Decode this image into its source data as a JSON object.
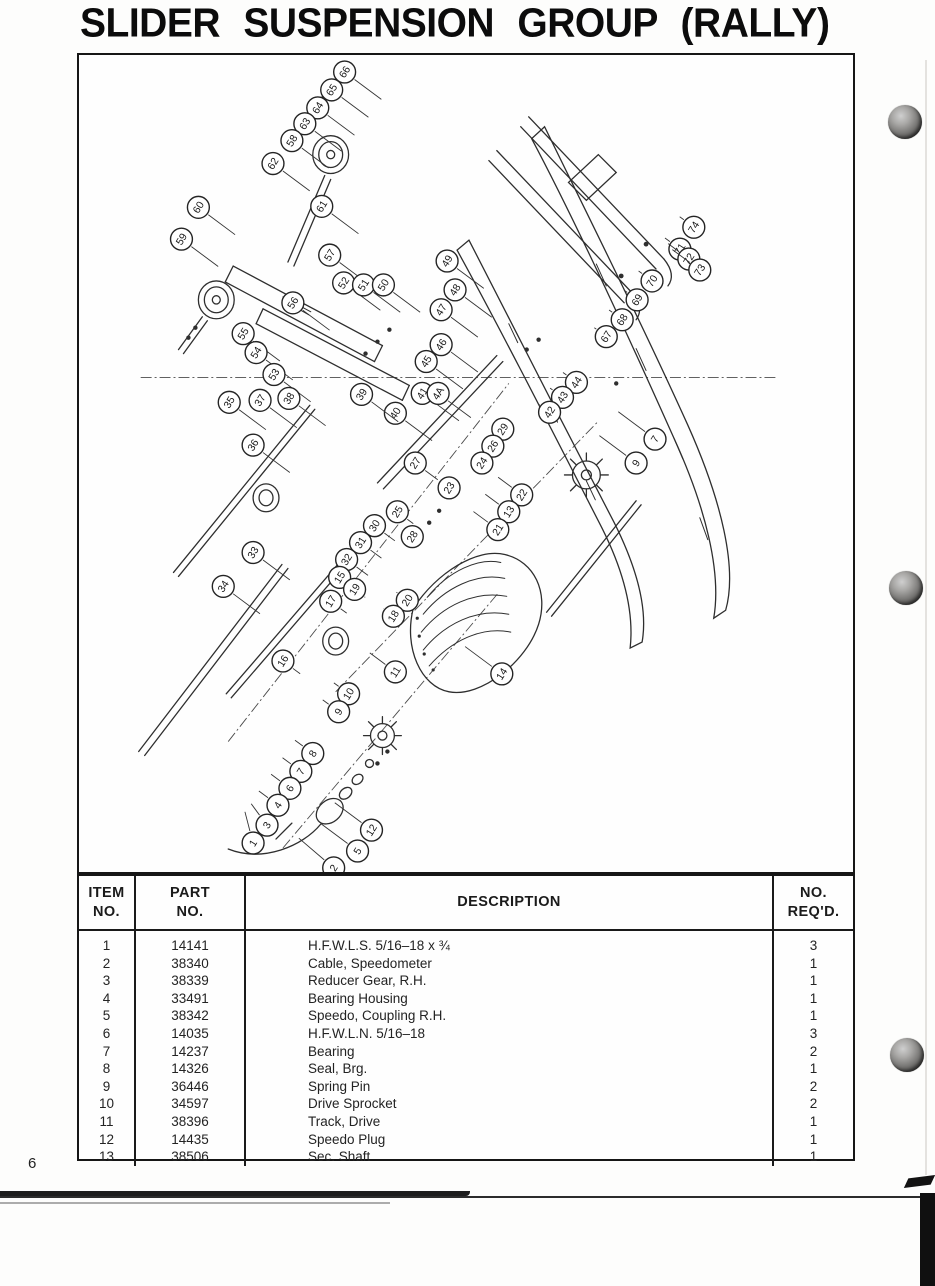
{
  "page": {
    "title": "SLIDER SUSPENSION GROUP (RALLY)",
    "page_number": "6"
  },
  "table": {
    "headers": {
      "item": [
        "ITEM",
        "NO."
      ],
      "part": [
        "PART",
        "NO."
      ],
      "description": "DESCRIPTION",
      "req": [
        "NO.",
        "REQ'D."
      ]
    },
    "rows": [
      {
        "item": "1",
        "part": "14141",
        "description": "H.F.W.L.S. 5/16–18 x ¾",
        "req": "3"
      },
      {
        "item": "2",
        "part": "38340",
        "description": "Cable, Speedometer",
        "req": "1"
      },
      {
        "item": "3",
        "part": "38339",
        "description": "Reducer Gear, R.H.",
        "req": "1"
      },
      {
        "item": "4",
        "part": "33491",
        "description": "Bearing Housing",
        "req": "1"
      },
      {
        "item": "5",
        "part": "38342",
        "description": "Speedo, Coupling R.H.",
        "req": "1"
      },
      {
        "item": "6",
        "part": "14035",
        "description": "H.F.W.L.N. 5/16–18",
        "req": "3"
      },
      {
        "item": "7",
        "part": "14237",
        "description": "Bearing",
        "req": "2"
      },
      {
        "item": "8",
        "part": "14326",
        "description": "Seal, Brg.",
        "req": "1"
      },
      {
        "item": "9",
        "part": "36446",
        "description": "Spring Pin",
        "req": "2"
      },
      {
        "item": "10",
        "part": "34597",
        "description": "Drive Sprocket",
        "req": "2"
      },
      {
        "item": "11",
        "part": "38396",
        "description": "Track, Drive",
        "req": "1"
      },
      {
        "item": "12",
        "part": "14435",
        "description": "Speedo Plug",
        "req": "1"
      },
      {
        "item": "13",
        "part": "38506",
        "description": "Sec. Shaft",
        "req": "1"
      }
    ]
  },
  "diagram": {
    "callouts": [
      {
        "n": "66",
        "x": 267,
        "y": 17
      },
      {
        "n": "65",
        "x": 254,
        "y": 35
      },
      {
        "n": "64",
        "x": 240,
        "y": 53
      },
      {
        "n": "63",
        "x": 227,
        "y": 69
      },
      {
        "n": "58",
        "x": 214,
        "y": 86
      },
      {
        "n": "62",
        "x": 195,
        "y": 109
      },
      {
        "n": "61",
        "x": 244,
        "y": 152
      },
      {
        "n": "60",
        "x": 120,
        "y": 153
      },
      {
        "n": "59",
        "x": 103,
        "y": 185
      },
      {
        "n": "57",
        "x": 252,
        "y": 201
      },
      {
        "n": "56",
        "x": 215,
        "y": 249
      },
      {
        "n": "55",
        "x": 165,
        "y": 280
      },
      {
        "n": "54",
        "x": 178,
        "y": 299
      },
      {
        "n": "53",
        "x": 196,
        "y": 321
      },
      {
        "n": "52",
        "x": 266,
        "y": 229
      },
      {
        "n": "51",
        "x": 286,
        "y": 231
      },
      {
        "n": "50",
        "x": 306,
        "y": 231
      },
      {
        "n": "49",
        "x": 370,
        "y": 207
      },
      {
        "n": "48",
        "x": 378,
        "y": 236
      },
      {
        "n": "47",
        "x": 364,
        "y": 256
      },
      {
        "n": "46",
        "x": 364,
        "y": 291
      },
      {
        "n": "45",
        "x": 349,
        "y": 308
      },
      {
        "n": "44",
        "x": 500,
        "y": 329
      },
      {
        "n": "43",
        "x": 486,
        "y": 344
      },
      {
        "n": "42",
        "x": 473,
        "y": 359
      },
      {
        "n": "41",
        "x": 345,
        "y": 340
      },
      {
        "n": "4A",
        "x": 361,
        "y": 340
      },
      {
        "n": "40",
        "x": 318,
        "y": 360
      },
      {
        "n": "39",
        "x": 284,
        "y": 341
      },
      {
        "n": "38",
        "x": 211,
        "y": 345
      },
      {
        "n": "37",
        "x": 182,
        "y": 347
      },
      {
        "n": "35",
        "x": 151,
        "y": 349
      },
      {
        "n": "36",
        "x": 175,
        "y": 392
      },
      {
        "n": "29",
        "x": 426,
        "y": 376
      },
      {
        "n": "26",
        "x": 416,
        "y": 393
      },
      {
        "n": "24",
        "x": 405,
        "y": 410
      },
      {
        "n": "27",
        "x": 338,
        "y": 410
      },
      {
        "n": "23",
        "x": 372,
        "y": 435
      },
      {
        "n": "25",
        "x": 320,
        "y": 459
      },
      {
        "n": "28",
        "x": 335,
        "y": 484
      },
      {
        "n": "22",
        "x": 445,
        "y": 442
      },
      {
        "n": "13",
        "x": 432,
        "y": 459
      },
      {
        "n": "21",
        "x": 421,
        "y": 477
      },
      {
        "n": "30",
        "x": 297,
        "y": 473
      },
      {
        "n": "31",
        "x": 283,
        "y": 490
      },
      {
        "n": "32",
        "x": 269,
        "y": 507
      },
      {
        "n": "33",
        "x": 175,
        "y": 500
      },
      {
        "n": "34",
        "x": 145,
        "y": 534
      },
      {
        "n": "7",
        "x": 579,
        "y": 386
      },
      {
        "n": "9",
        "x": 560,
        "y": 410
      },
      {
        "n": "15",
        "x": 262,
        "y": 525
      },
      {
        "n": "19",
        "x": 277,
        "y": 537
      },
      {
        "n": "17",
        "x": 253,
        "y": 549
      },
      {
        "n": "20",
        "x": 330,
        "y": 548
      },
      {
        "n": "18",
        "x": 316,
        "y": 564
      },
      {
        "n": "16",
        "x": 205,
        "y": 609
      },
      {
        "n": "11",
        "x": 318,
        "y": 620
      },
      {
        "n": "14",
        "x": 425,
        "y": 622
      },
      {
        "n": "10",
        "x": 271,
        "y": 642
      },
      {
        "n": "9",
        "x": 261,
        "y": 660
      },
      {
        "n": "8",
        "x": 235,
        "y": 702
      },
      {
        "n": "7",
        "x": 223,
        "y": 720
      },
      {
        "n": "6",
        "x": 212,
        "y": 737
      },
      {
        "n": "4",
        "x": 200,
        "y": 754
      },
      {
        "n": "3",
        "x": 189,
        "y": 774
      },
      {
        "n": "1",
        "x": 175,
        "y": 792
      },
      {
        "n": "12",
        "x": 294,
        "y": 779
      },
      {
        "n": "5",
        "x": 280,
        "y": 800
      },
      {
        "n": "2",
        "x": 256,
        "y": 817
      },
      {
        "n": "67",
        "x": 530,
        "y": 283
      },
      {
        "n": "68",
        "x": 546,
        "y": 266
      },
      {
        "n": "69",
        "x": 561,
        "y": 246
      },
      {
        "n": "70",
        "x": 576,
        "y": 227
      },
      {
        "n": "71",
        "x": 604,
        "y": 195
      },
      {
        "n": "72",
        "x": 613,
        "y": 205
      },
      {
        "n": "73",
        "x": 624,
        "y": 216
      },
      {
        "n": "74",
        "x": 618,
        "y": 173
      }
    ]
  }
}
